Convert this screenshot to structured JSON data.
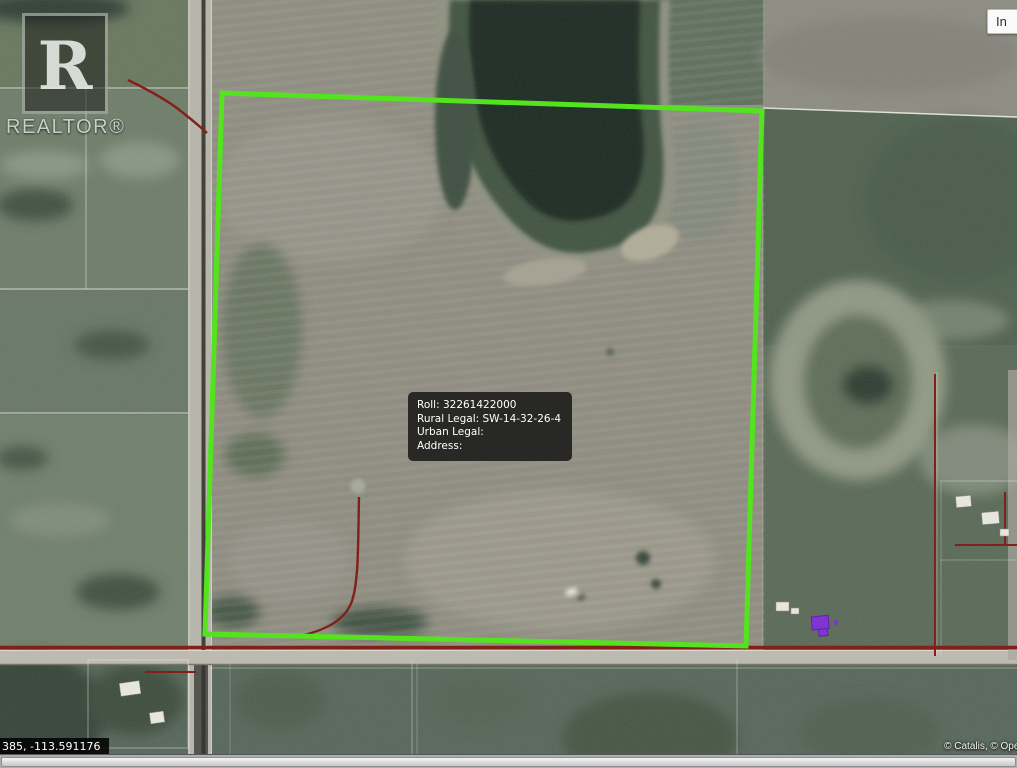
{
  "watermark": {
    "logo_letter": "R",
    "label": "REALTOR®"
  },
  "controls": {
    "top_right_button_label": "In"
  },
  "tooltip": {
    "lines": [
      "Roll: 32261422000",
      "Rural Legal: SW-14-32-26-4",
      "Urban Legal:",
      "Address:"
    ]
  },
  "statusbar": {
    "coordinates": "385, -113.591176",
    "attribution": "© Catalis, © Open"
  },
  "colors": {
    "boundary": "#4de614",
    "cadastral-red": "#7d160e",
    "building-purple": "#7e2bd4",
    "tooltip-bg": "rgba(17,17,17,0.82)",
    "overlay-bg": "rgba(0,0,0,0.85)"
  }
}
